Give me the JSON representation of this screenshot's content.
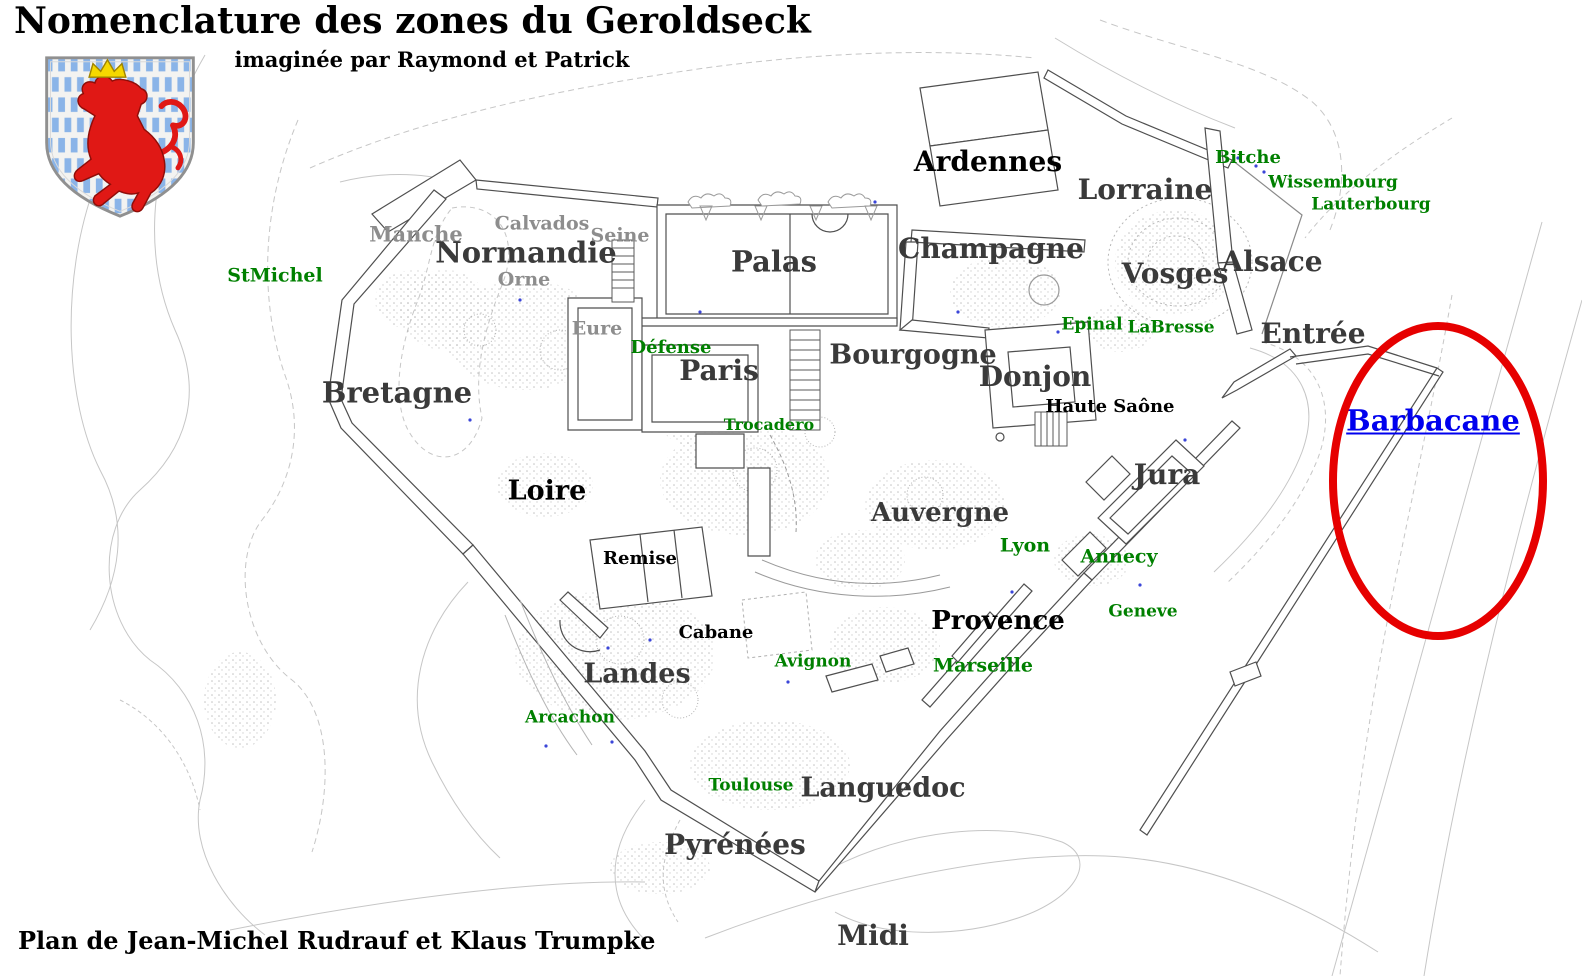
{
  "title": "Nomenclature des zones du Geroldseck",
  "subtitle": "imaginée par Raymond et Patrick",
  "credit": "Plan de Jean-Michel Rudrauf et Klaus Trumpke",
  "coat_of_arms": {
    "name": "luxembourg-lion-shield",
    "description": "red crowned rampant lion on white field with blue bars"
  },
  "colors": {
    "black": "#000000",
    "dark": "#3a3a3a",
    "gray": "#8d8d8d",
    "green": "#008000",
    "blue": "#0000ee",
    "red": "#e60000",
    "plan_line": "#4f4f4f",
    "contour_line": "#c6c6c6"
  },
  "highlight": {
    "label": "Barbacane",
    "shape": "ellipse",
    "ellipse_color_key": "red"
  },
  "map_labels": [
    {
      "text": "StMichel",
      "x": 275,
      "y": 276,
      "size": 19,
      "color": "green"
    },
    {
      "text": "Manche",
      "x": 416,
      "y": 234,
      "size": 21,
      "color": "gray"
    },
    {
      "text": "Calvados",
      "x": 542,
      "y": 224,
      "size": 19,
      "color": "gray"
    },
    {
      "text": "Normandie",
      "x": 526,
      "y": 253,
      "size": 29,
      "color": "dark"
    },
    {
      "text": "Seine",
      "x": 620,
      "y": 236,
      "size": 19,
      "color": "gray"
    },
    {
      "text": "Orne",
      "x": 524,
      "y": 280,
      "size": 19,
      "color": "gray"
    },
    {
      "text": "Eure",
      "x": 597,
      "y": 329,
      "size": 19,
      "color": "gray"
    },
    {
      "text": "Défense",
      "x": 671,
      "y": 348,
      "size": 18,
      "color": "green"
    },
    {
      "text": "Palas",
      "x": 774,
      "y": 262,
      "size": 29,
      "color": "dark"
    },
    {
      "text": "Paris",
      "x": 719,
      "y": 371,
      "size": 28,
      "color": "dark"
    },
    {
      "text": "Trocadero",
      "x": 769,
      "y": 425,
      "size": 16,
      "color": "green"
    },
    {
      "text": "Bretagne",
      "x": 397,
      "y": 393,
      "size": 29,
      "color": "dark"
    },
    {
      "text": "Loire",
      "x": 547,
      "y": 491,
      "size": 27,
      "color": "black"
    },
    {
      "text": "Ardennes",
      "x": 988,
      "y": 162,
      "size": 28,
      "color": "black"
    },
    {
      "text": "Lorraine",
      "x": 1145,
      "y": 190,
      "size": 28,
      "color": "dark"
    },
    {
      "text": "Champagne",
      "x": 991,
      "y": 249,
      "size": 28,
      "color": "dark"
    },
    {
      "text": "Bitche",
      "x": 1248,
      "y": 158,
      "size": 18,
      "color": "green"
    },
    {
      "text": "Wissembourg",
      "x": 1333,
      "y": 183,
      "size": 17,
      "color": "green"
    },
    {
      "text": "Lauterbourg",
      "x": 1371,
      "y": 205,
      "size": 17,
      "color": "green"
    },
    {
      "text": "Vosges",
      "x": 1175,
      "y": 274,
      "size": 28,
      "color": "dark"
    },
    {
      "text": "Alsace",
      "x": 1272,
      "y": 262,
      "size": 28,
      "color": "dark"
    },
    {
      "text": "Entrée",
      "x": 1313,
      "y": 334,
      "size": 28,
      "color": "dark"
    },
    {
      "text": "Epinal",
      "x": 1092,
      "y": 325,
      "size": 17,
      "color": "green"
    },
    {
      "text": "LaBresse",
      "x": 1171,
      "y": 328,
      "size": 17,
      "color": "green"
    },
    {
      "text": "Bourgogne",
      "x": 913,
      "y": 355,
      "size": 27,
      "color": "dark"
    },
    {
      "text": "Donjon",
      "x": 1035,
      "y": 377,
      "size": 28,
      "color": "dark"
    },
    {
      "text": "Haute Saône",
      "x": 1110,
      "y": 407,
      "size": 18,
      "color": "black"
    },
    {
      "text": "Jura",
      "x": 1167,
      "y": 475,
      "size": 28,
      "color": "dark"
    },
    {
      "text": "Barbacane",
      "x": 1433,
      "y": 421,
      "size": 29,
      "color": "blue",
      "underline": true,
      "interactable": true
    },
    {
      "text": "Auvergne",
      "x": 940,
      "y": 513,
      "size": 26,
      "color": "dark"
    },
    {
      "text": "Lyon",
      "x": 1025,
      "y": 546,
      "size": 19,
      "color": "green"
    },
    {
      "text": "Annecy",
      "x": 1119,
      "y": 557,
      "size": 19,
      "color": "green"
    },
    {
      "text": "Geneve",
      "x": 1143,
      "y": 612,
      "size": 17,
      "color": "green"
    },
    {
      "text": "Remise",
      "x": 640,
      "y": 559,
      "size": 18,
      "color": "black"
    },
    {
      "text": "Cabane",
      "x": 716,
      "y": 633,
      "size": 18,
      "color": "black"
    },
    {
      "text": "Provence",
      "x": 998,
      "y": 621,
      "size": 26,
      "color": "black"
    },
    {
      "text": "Marseille",
      "x": 983,
      "y": 666,
      "size": 19,
      "color": "green"
    },
    {
      "text": "Avignon",
      "x": 813,
      "y": 662,
      "size": 17,
      "color": "green"
    },
    {
      "text": "Landes",
      "x": 637,
      "y": 674,
      "size": 27,
      "color": "dark"
    },
    {
      "text": "Arcachon",
      "x": 570,
      "y": 718,
      "size": 17,
      "color": "green"
    },
    {
      "text": "Toulouse",
      "x": 751,
      "y": 786,
      "size": 17,
      "color": "green"
    },
    {
      "text": "Languedoc",
      "x": 883,
      "y": 788,
      "size": 27,
      "color": "dark"
    },
    {
      "text": "Pyrénées",
      "x": 735,
      "y": 845,
      "size": 28,
      "color": "dark"
    },
    {
      "text": "Midi",
      "x": 873,
      "y": 936,
      "size": 28,
      "color": "dark"
    }
  ]
}
